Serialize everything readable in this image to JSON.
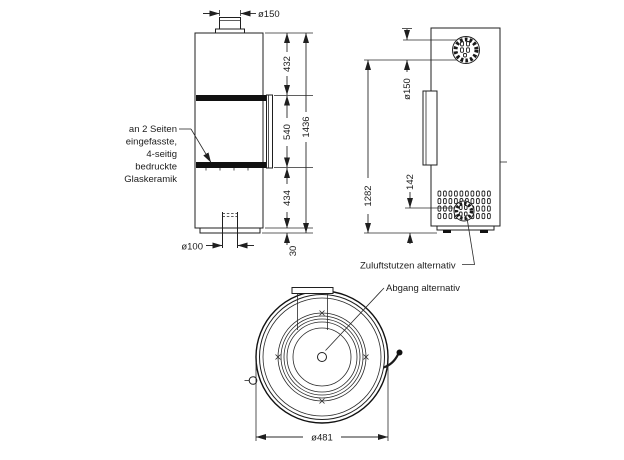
{
  "front": {
    "flue_dia": "ø150",
    "h_top": "432",
    "h_glass": "540",
    "h_bottom": "434",
    "h_total": "1436",
    "h_plinth": "30",
    "inlet_dia": "ø100",
    "note": [
      "an 2 Seiten",
      "eingefasste,",
      "4-seitig",
      "bedruckte",
      "Glaskeramik"
    ]
  },
  "side": {
    "flue_dia": "ø150",
    "h_flue": "1282",
    "h_inlet": "142"
  },
  "top": {
    "dia": "ø481",
    "label_zuluft": "Zuluftstutzen alternativ",
    "label_abgang": "Abgang alternativ"
  },
  "colors": {
    "line": "#1f1f1f",
    "background": "#ffffff"
  }
}
